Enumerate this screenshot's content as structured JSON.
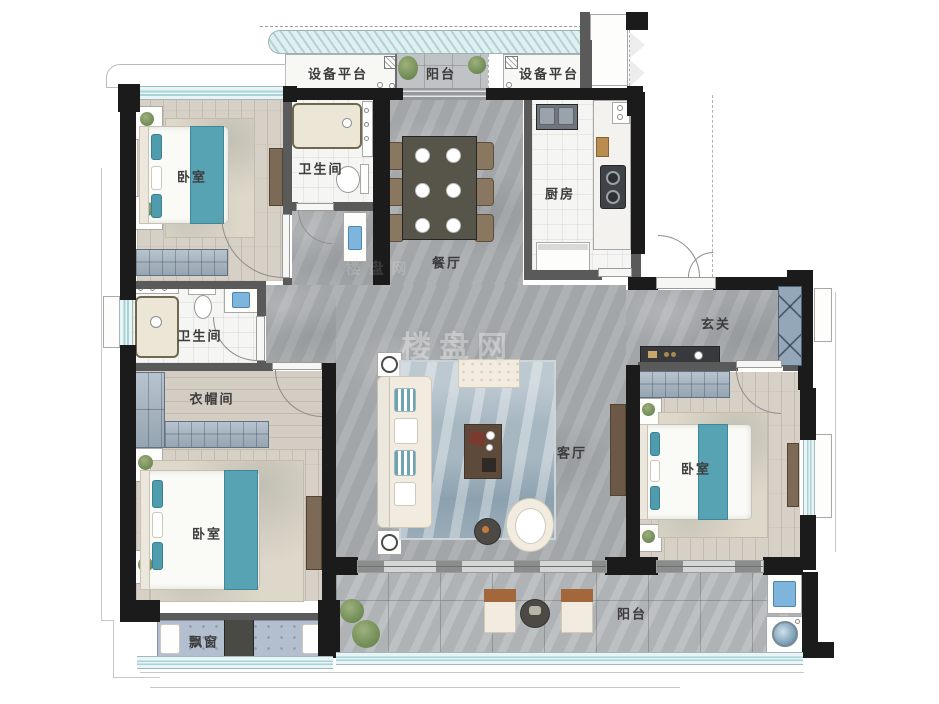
{
  "rooms": [
    {
      "id": "equip-left",
      "label": "设备平台"
    },
    {
      "id": "balcony-top",
      "label": "阳台"
    },
    {
      "id": "equip-right",
      "label": "设备平台"
    },
    {
      "id": "bedroom-1",
      "label": "卧室"
    },
    {
      "id": "bath-1",
      "label": "卫生间"
    },
    {
      "id": "dining",
      "label": "餐厅"
    },
    {
      "id": "kitchen",
      "label": "厨房"
    },
    {
      "id": "entry",
      "label": "玄关"
    },
    {
      "id": "bath-2",
      "label": "卫生间"
    },
    {
      "id": "cloakroom",
      "label": "衣帽间"
    },
    {
      "id": "living",
      "label": "客厅"
    },
    {
      "id": "bedroom-2",
      "label": "卧室"
    },
    {
      "id": "bedroom-3",
      "label": "卧室"
    },
    {
      "id": "bay-window",
      "label": "飘窗"
    },
    {
      "id": "balcony-bottom",
      "label": "阳台"
    }
  ],
  "watermark": {
    "text": "楼盘网"
  },
  "colors": {
    "wall": "#1b1b1b",
    "interior_wall": "#5a5a5a",
    "window": "#e8f4f5",
    "window_stripe": "#a9d2d6",
    "floor_marble": "#a9acae",
    "floor_wood": "#d7d0c6",
    "floor_tile": "#f5f5f3",
    "accent_teal": "#57a2b3",
    "furniture_cream": "#f1ecdf",
    "furniture_wood": "#7c6a56",
    "wardrobe_blue": "#9fafbd",
    "rug_blue": "#a7b7c2"
  }
}
